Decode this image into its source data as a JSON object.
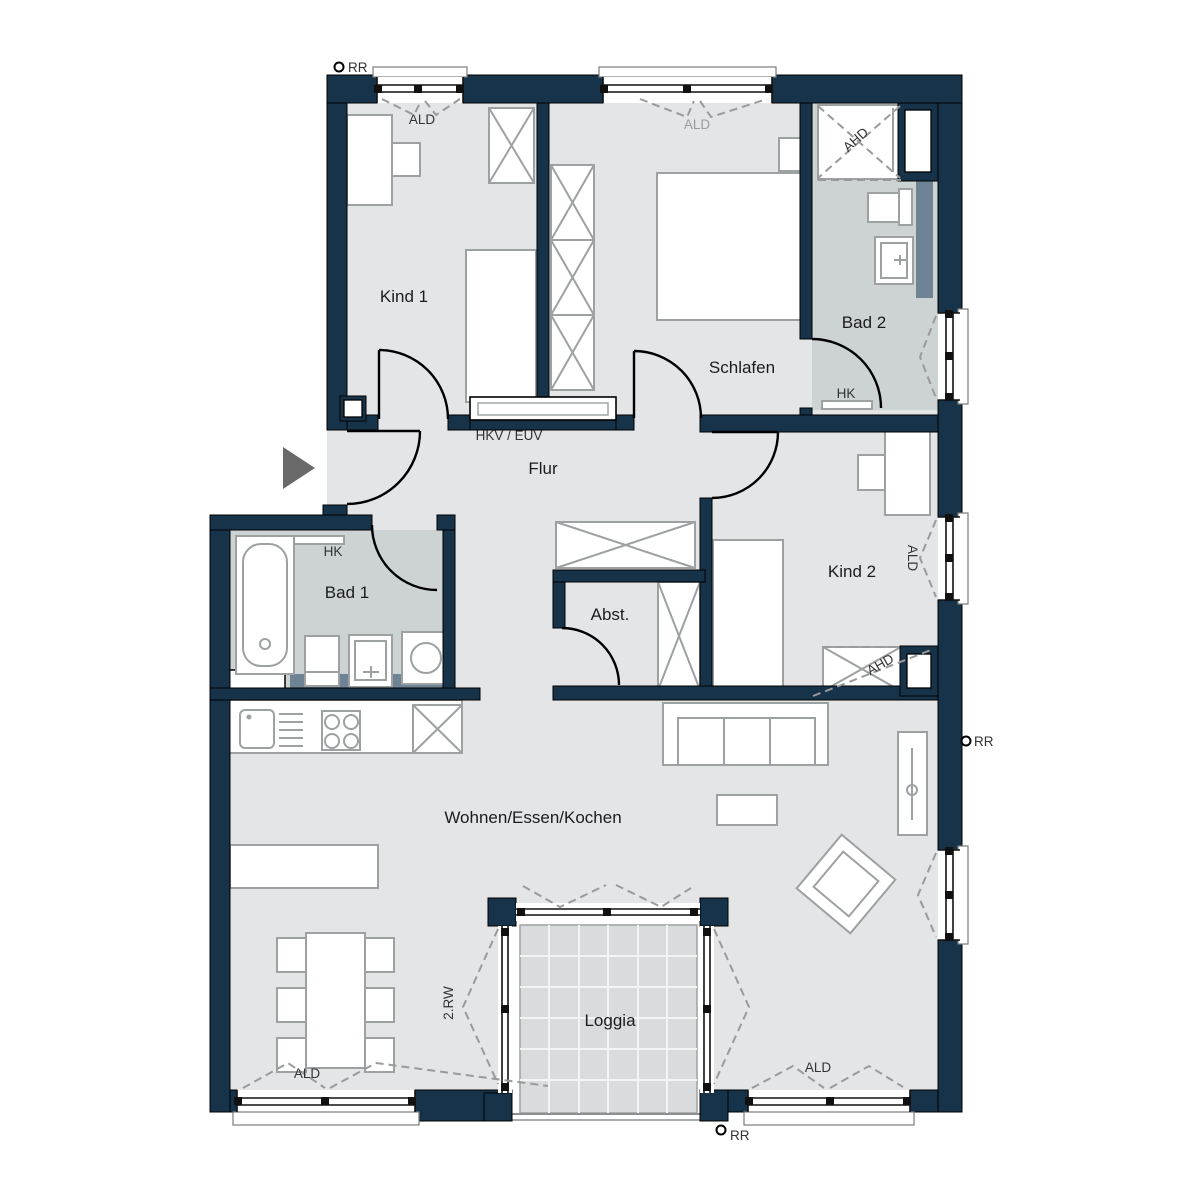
{
  "title": "Apartment floor plan",
  "rooms": {
    "kind1": "Kind 1",
    "schlafen": "Schlafen",
    "bad2": "Bad 2",
    "flur": "Flur",
    "bad1": "Bad 1",
    "abst": "Abst.",
    "kind2": "Kind 2",
    "wohnen": "Wohnen/Essen/Kochen",
    "loggia": "Loggia"
  },
  "annotations": {
    "rr_top": "RR",
    "rr_right": "RR",
    "rr_bottom": "RR",
    "ald_kind1": "ALD",
    "ald_schlafen": "ALD",
    "ald_kind2": "ALD",
    "ald_bottom_left": "ALD",
    "ald_bottom_right": "ALD",
    "ahd_bad2": "AHD",
    "ahd_kind2": "AHD",
    "hk_bad1": "HK",
    "hk_bad2": "HK",
    "hkv_euv": "HKV / EUV",
    "escape_route": "2.RW"
  },
  "colors": {
    "wall": "#17334a",
    "floor": "#e4e5e6",
    "bath_floor": "#cdd2d2",
    "loggia_floor": "#d9dbdc",
    "prewall_installation": "#6e8494",
    "furniture_outline": "#9da1a1",
    "dashed_indicator": "#9a9a9a",
    "entry_arrow": "#696969"
  }
}
